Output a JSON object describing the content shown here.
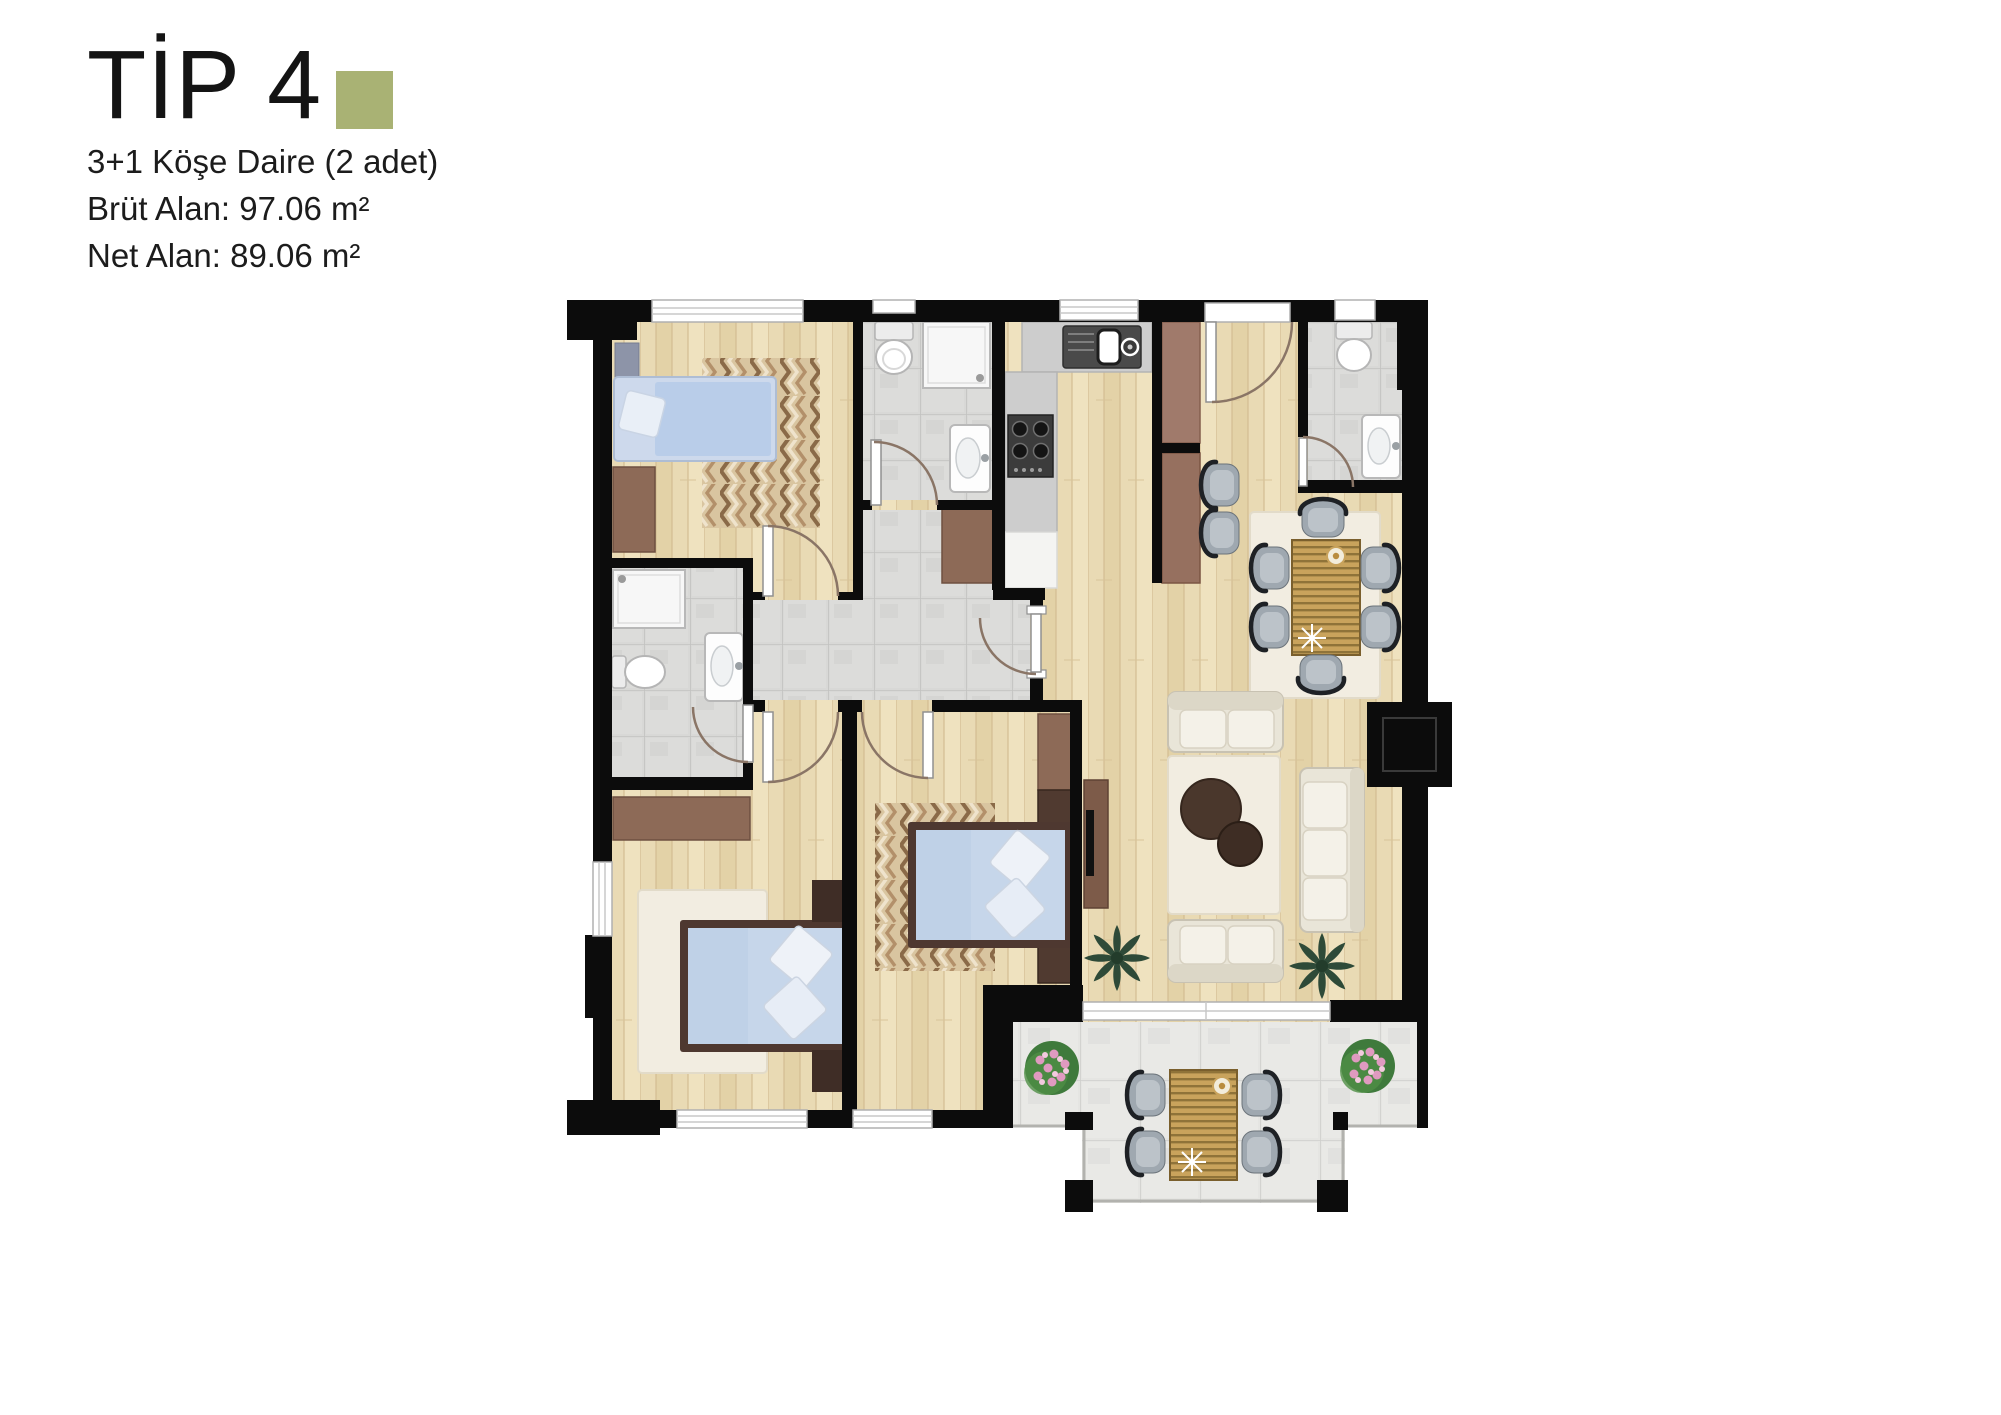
{
  "header": {
    "title": "TİP 4",
    "subtitle": "3+1 Köşe Daire (2 adet)",
    "gross_area": "Brüt Alan: 97.06 m²",
    "net_area": "Net Alan: 89.06 m²"
  },
  "colors": {
    "accent": "#a9b274",
    "wall": "#0c0c0c",
    "wood": "#e9dab4",
    "tile": "#d8d8d6",
    "balcony-tile": "#e5e5e2",
    "rug-cream": "#f2ede1",
    "bed-blue": "#c3d4ea",
    "furniture-brown": "#8d6a57",
    "furniture-dark-brown": "#503a30",
    "sofa-cream": "#eceadd",
    "chair-gray": "#9fa8b0",
    "plant-green": "#2e4a38"
  }
}
